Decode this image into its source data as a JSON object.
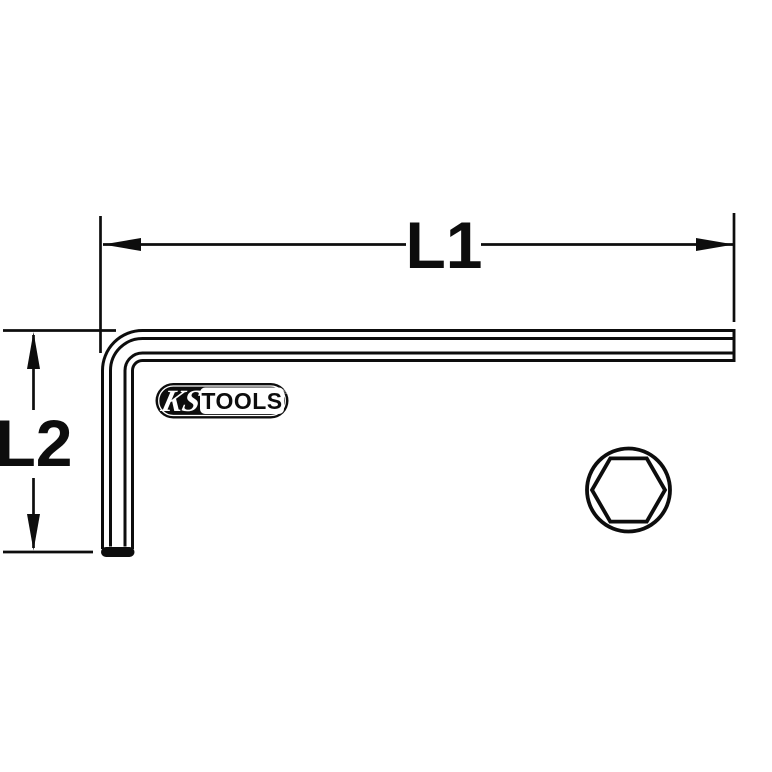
{
  "colors": {
    "line": "#0d0d0d",
    "background": "#ffffff",
    "logo_fill": "#0d0d0d",
    "logo_text": "#ffffff"
  },
  "drawing": {
    "subject": "L-shaped hex key (Allen key) technical line drawing",
    "dimensions": {
      "long_arm_label": "L1",
      "short_arm_label": "L2"
    },
    "logo": {
      "script_text": "KS",
      "word_text": "TOOLS",
      "registered_mark": "®"
    },
    "cross_section": {
      "shape": "hexagon inside circle"
    }
  }
}
